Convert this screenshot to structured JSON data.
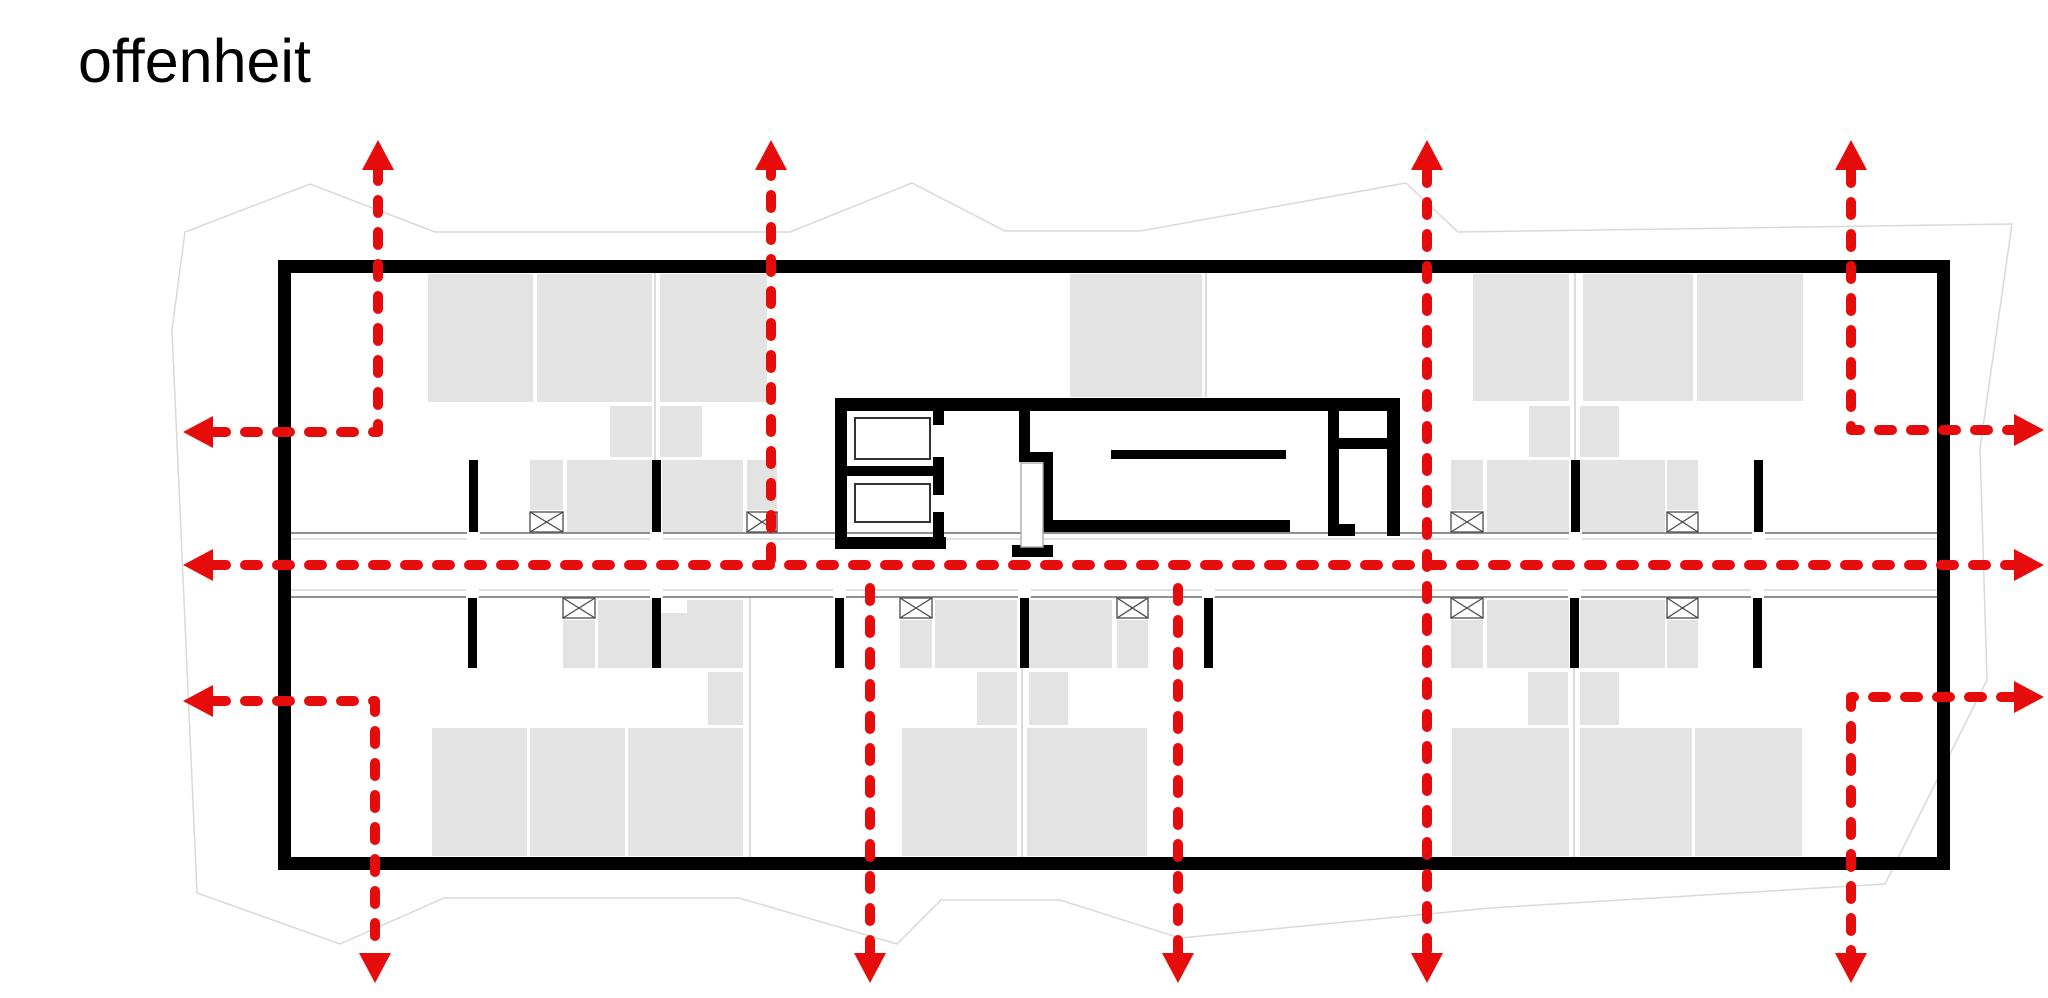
{
  "title": "offenheit",
  "canvas": {
    "width": 2048,
    "height": 998
  },
  "colors": {
    "background": "#ffffff",
    "arrow_red": "#e60c0c",
    "wall_black": "#000000",
    "furniture_gray": "#e3e3e3",
    "partition_gray": "#cfcfcf",
    "site_gray": "#d9d9d9",
    "corridor_dark": "#8f8f8f",
    "corridor_light": "#cfcfcf",
    "fixture_stroke": "#333333",
    "symbol_stroke": "#4a4a4a"
  },
  "site_boundary": {
    "points": [
      [
        185,
        232
      ],
      [
        310,
        184
      ],
      [
        435,
        232
      ],
      [
        790,
        232
      ],
      [
        912,
        183
      ],
      [
        1005,
        231
      ],
      [
        1140,
        231
      ],
      [
        1406,
        183
      ],
      [
        1458,
        232
      ],
      [
        2012,
        224
      ],
      [
        1980,
        448
      ],
      [
        1987,
        680
      ],
      [
        1885,
        884
      ],
      [
        1490,
        908
      ],
      [
        1180,
        938
      ],
      [
        1060,
        900
      ],
      [
        941,
        900
      ],
      [
        897,
        944
      ],
      [
        739,
        898
      ],
      [
        444,
        898
      ],
      [
        340,
        944
      ],
      [
        197,
        893
      ],
      [
        172,
        330
      ]
    ]
  },
  "building_walls": [
    [
      278,
      260,
      1672,
      13
    ],
    [
      278,
      857,
      1672,
      13
    ],
    [
      278,
      260,
      13,
      610
    ],
    [
      1937,
      260,
      13,
      610
    ]
  ],
  "interior_walls": [
    [
      469,
      460,
      9,
      72
    ],
    [
      652,
      460,
      9,
      72
    ],
    [
      1571,
      460,
      9,
      72
    ],
    [
      1754,
      460,
      9,
      72
    ],
    [
      468,
      598,
      9,
      70
    ],
    [
      652,
      598,
      9,
      70
    ],
    [
      835,
      598,
      9,
      70
    ],
    [
      1020,
      598,
      9,
      70
    ],
    [
      1204,
      598,
      9,
      70
    ],
    [
      1570,
      598,
      9,
      70
    ],
    [
      1753,
      598,
      9,
      70
    ]
  ],
  "core_walls": [
    [
      835,
      398,
      565,
      13
    ],
    [
      835,
      398,
      12,
      151
    ],
    [
      835,
      537,
      111,
      12
    ],
    [
      933,
      411,
      11,
      14
    ],
    [
      933,
      457,
      11,
      38
    ],
    [
      933,
      512,
      11,
      37
    ],
    [
      847,
      466,
      86,
      10
    ],
    [
      1019,
      411,
      11,
      51
    ],
    [
      1019,
      452,
      34,
      10
    ],
    [
      1043,
      452,
      10,
      80
    ],
    [
      1012,
      545,
      41,
      12
    ],
    [
      1044,
      520,
      246,
      12
    ],
    [
      1111,
      450,
      175,
      9
    ],
    [
      1328,
      398,
      11,
      138
    ],
    [
      1328,
      524,
      27,
      12
    ],
    [
      1336,
      438,
      54,
      11
    ],
    [
      1387,
      398,
      13,
      138
    ]
  ],
  "elevator_cabins": [
    [
      855,
      418,
      75,
      41
    ],
    [
      855,
      484,
      75,
      38
    ]
  ],
  "stair_shaft": [
    1021,
    463,
    22,
    84
  ],
  "furniture": [
    [
      428,
      274,
      105,
      128
    ],
    [
      537,
      274,
      115,
      128
    ],
    [
      660,
      274,
      107,
      128
    ],
    [
      610,
      406,
      42,
      51
    ],
    [
      660,
      406,
      42,
      51
    ],
    [
      530,
      460,
      33,
      50
    ],
    [
      567,
      460,
      85,
      72
    ],
    [
      662,
      460,
      81,
      72
    ],
    [
      747,
      460,
      30,
      50
    ],
    [
      1070,
      274,
      132,
      123
    ],
    [
      1473,
      274,
      96,
      127
    ],
    [
      1583,
      274,
      110,
      127
    ],
    [
      1697,
      274,
      106,
      127
    ],
    [
      1529,
      406,
      41,
      51
    ],
    [
      1580,
      406,
      39,
      51
    ],
    [
      1451,
      460,
      32,
      50
    ],
    [
      1487,
      460,
      82,
      72
    ],
    [
      1580,
      460,
      85,
      72
    ],
    [
      1667,
      460,
      31,
      50
    ],
    [
      563,
      620,
      32,
      48
    ],
    [
      598,
      600,
      54,
      68
    ],
    [
      661,
      613,
      26,
      55
    ],
    [
      687,
      600,
      56,
      68
    ],
    [
      708,
      672,
      35,
      53
    ],
    [
      432,
      728,
      95,
      128
    ],
    [
      530,
      728,
      95,
      128
    ],
    [
      628,
      728,
      115,
      128
    ],
    [
      900,
      620,
      32,
      48
    ],
    [
      935,
      600,
      82,
      68
    ],
    [
      1029,
      600,
      83,
      68
    ],
    [
      1117,
      620,
      31,
      48
    ],
    [
      977,
      672,
      40,
      53
    ],
    [
      1029,
      672,
      39,
      53
    ],
    [
      902,
      728,
      115,
      128
    ],
    [
      1027,
      728,
      120,
      128
    ],
    [
      1451,
      620,
      32,
      48
    ],
    [
      1487,
      600,
      82,
      68
    ],
    [
      1580,
      600,
      85,
      68
    ],
    [
      1667,
      620,
      31,
      48
    ],
    [
      1528,
      672,
      40,
      53
    ],
    [
      1580,
      672,
      39,
      53
    ],
    [
      1452,
      728,
      117,
      128
    ],
    [
      1580,
      728,
      112,
      128
    ],
    [
      1695,
      728,
      107,
      128
    ]
  ],
  "partitions": [
    [
      655,
      273,
      460
    ],
    [
      1206,
      273,
      397
    ],
    [
      1575,
      273,
      460
    ],
    [
      750,
      598,
      857
    ],
    [
      1022,
      598,
      857
    ],
    [
      1574,
      598,
      857
    ]
  ],
  "corridor": {
    "x1": 291,
    "x2": 1937,
    "lines": [
      {
        "y": 533,
        "tone": "dark",
        "w": 2
      },
      {
        "y": 539,
        "tone": "light",
        "w": 1.2
      },
      {
        "y": 590,
        "tone": "light",
        "w": 1.2
      },
      {
        "y": 597,
        "tone": "dark",
        "w": 2
      }
    ],
    "gaps_top": [
      469,
      652,
      1571,
      1754
    ],
    "gaps_bottom": [
      468,
      652,
      835,
      1020,
      1204,
      1570,
      1753
    ]
  },
  "crossing_symbols": [
    [
      530,
      512,
      33,
      20
    ],
    [
      747,
      512,
      30,
      20
    ],
    [
      1451,
      512,
      32,
      20
    ],
    [
      1667,
      512,
      31,
      20
    ],
    [
      563,
      598,
      32,
      20
    ],
    [
      900,
      598,
      32,
      20
    ],
    [
      1117,
      598,
      31,
      20
    ],
    [
      1451,
      598,
      32,
      20
    ],
    [
      1667,
      598,
      31,
      20
    ]
  ],
  "arrows": {
    "stroke_width": 10,
    "dash": "13 19",
    "head_length": 30,
    "head_halfwidth": 16,
    "items": [
      {
        "name": "top-left-L",
        "shaft": [
          [
            213,
            432
          ],
          [
            378,
            432
          ],
          [
            378,
            170
          ]
        ],
        "heads": [
          {
            "x": 183,
            "y": 432,
            "dir": "left"
          },
          {
            "x": 378,
            "y": 140,
            "dir": "up"
          }
        ]
      },
      {
        "name": "top-2",
        "shaft": [
          [
            771,
            560
          ],
          [
            771,
            170
          ]
        ],
        "heads": [
          {
            "x": 771,
            "y": 140,
            "dir": "up"
          }
        ]
      },
      {
        "name": "through-vertical",
        "shaft": [
          [
            1427,
            170
          ],
          [
            1427,
            953
          ]
        ],
        "heads": [
          {
            "x": 1427,
            "y": 140,
            "dir": "up"
          },
          {
            "x": 1427,
            "y": 983,
            "dir": "down"
          }
        ]
      },
      {
        "name": "top-right-L",
        "shaft": [
          [
            1851,
            170
          ],
          [
            1851,
            430
          ],
          [
            2014,
            430
          ]
        ],
        "heads": [
          {
            "x": 1851,
            "y": 140,
            "dir": "up"
          },
          {
            "x": 2044,
            "y": 430,
            "dir": "right"
          }
        ]
      },
      {
        "name": "center-horizontal",
        "shaft": [
          [
            213,
            565
          ],
          [
            2014,
            565
          ]
        ],
        "heads": [
          {
            "x": 183,
            "y": 565,
            "dir": "left"
          },
          {
            "x": 2044,
            "y": 565,
            "dir": "right"
          }
        ]
      },
      {
        "name": "bottom-left-L",
        "shaft": [
          [
            213,
            701
          ],
          [
            375,
            701
          ],
          [
            375,
            953
          ]
        ],
        "heads": [
          {
            "x": 183,
            "y": 701,
            "dir": "left"
          },
          {
            "x": 375,
            "y": 983,
            "dir": "down"
          }
        ]
      },
      {
        "name": "bottom-2",
        "shaft": [
          [
            870,
            588
          ],
          [
            870,
            953
          ]
        ],
        "heads": [
          {
            "x": 870,
            "y": 983,
            "dir": "down"
          }
        ]
      },
      {
        "name": "bottom-3",
        "shaft": [
          [
            1178,
            588
          ],
          [
            1178,
            953
          ]
        ],
        "heads": [
          {
            "x": 1178,
            "y": 983,
            "dir": "down"
          }
        ]
      },
      {
        "name": "bottom-right-L",
        "shaft": [
          [
            2014,
            697
          ],
          [
            1851,
            697
          ],
          [
            1851,
            953
          ]
        ],
        "heads": [
          {
            "x": 2044,
            "y": 697,
            "dir": "right"
          },
          {
            "x": 1851,
            "y": 983,
            "dir": "down"
          }
        ]
      }
    ]
  }
}
